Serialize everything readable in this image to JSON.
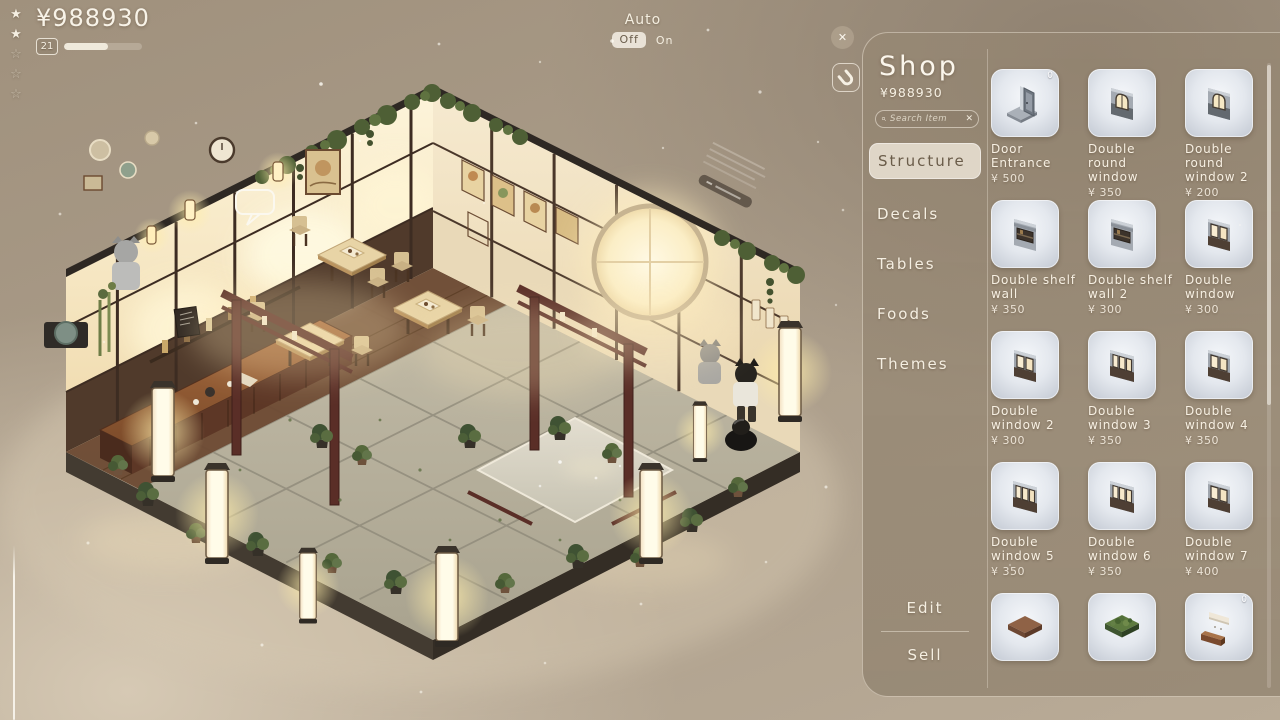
{
  "hud": {
    "currency": "¥988930",
    "level": "21",
    "level_progress": 57,
    "stars": {
      "filled": 2,
      "total": 5
    },
    "auto": {
      "label": "Auto",
      "off": "Off",
      "on": "On"
    },
    "close": "✕"
  },
  "panel": {
    "title": "Shop",
    "balance": "¥988930",
    "search": {
      "placeholder": "Search Item",
      "clear": "✕"
    },
    "categories": [
      {
        "label": "Structure",
        "selected": true
      },
      {
        "label": "Decals",
        "selected": false
      },
      {
        "label": "Tables",
        "selected": false
      },
      {
        "label": "Foods",
        "selected": false
      },
      {
        "label": "Themes",
        "selected": false
      }
    ],
    "actions": {
      "edit": "Edit",
      "sell": "Sell"
    },
    "items": [
      {
        "name": "Door Entrance",
        "price": "¥ 500",
        "badge": "0",
        "icon": "door-entrance"
      },
      {
        "name": "Double round window",
        "price": "¥ 350",
        "badge": "",
        "icon": "round-window"
      },
      {
        "name": "Double round window 2",
        "price": "¥ 200",
        "badge": "",
        "icon": "round-window"
      },
      {
        "name": "Double shelf wall",
        "price": "¥ 350",
        "badge": "",
        "icon": "shelf-wall"
      },
      {
        "name": "Double shelf wall 2",
        "price": "¥ 300",
        "badge": "",
        "icon": "shelf-wall"
      },
      {
        "name": "Double window",
        "price": "¥ 300",
        "badge": "",
        "icon": "window"
      },
      {
        "name": "Double window 2",
        "price": "¥ 300",
        "badge": "",
        "icon": "window"
      },
      {
        "name": "Double window 3",
        "price": "¥ 350",
        "badge": "",
        "icon": "window-wide"
      },
      {
        "name": "Double window 4",
        "price": "¥ 350",
        "badge": "",
        "icon": "window"
      },
      {
        "name": "Double window 5",
        "price": "¥ 350",
        "badge": "",
        "icon": "window-wide"
      },
      {
        "name": "Double window 6",
        "price": "¥ 350",
        "badge": "",
        "icon": "window-wide"
      },
      {
        "name": "Double window 7",
        "price": "¥ 400",
        "badge": "",
        "icon": "window"
      },
      {
        "name": "",
        "price": "",
        "badge": "",
        "icon": "floor-tile"
      },
      {
        "name": "",
        "price": "",
        "badge": "",
        "icon": "grass-tile"
      },
      {
        "name": "",
        "price": "",
        "badge": "0",
        "icon": "wall-counter"
      }
    ]
  }
}
